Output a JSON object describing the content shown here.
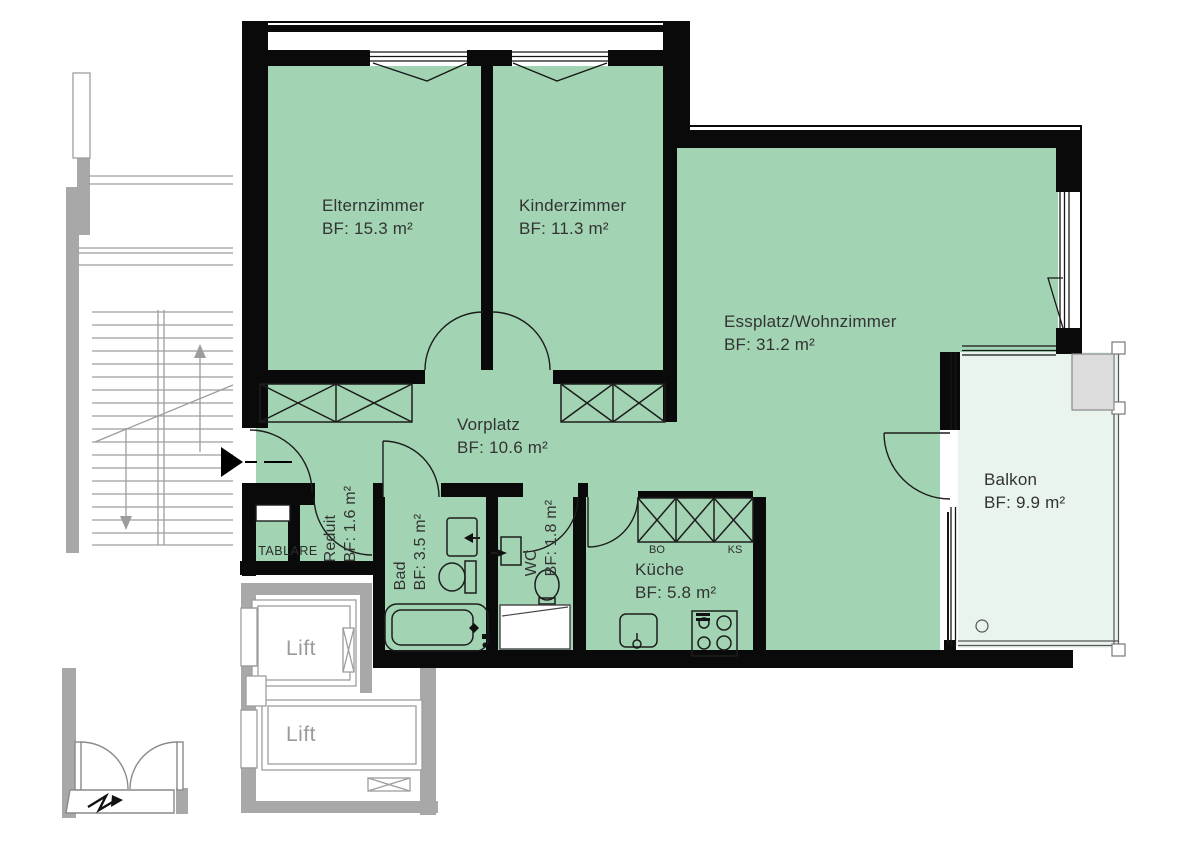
{
  "plan": {
    "title": "Apartment floor plan",
    "rooms": [
      {
        "name": "Elternzimmer",
        "area": "BF: 15.3 m²"
      },
      {
        "name": "Kinderzimmer",
        "area": "BF: 11.3 m²"
      },
      {
        "name": "Essplatz/Wohnzimmer",
        "area": "BF: 31.2 m²"
      },
      {
        "name": "Vorplatz",
        "area": "BF: 10.6 m²"
      },
      {
        "name": "Balkon",
        "area": "BF: 9.9 m²"
      },
      {
        "name": "Küche",
        "area": "BF: 5.8 m²"
      },
      {
        "name": "Reduit",
        "area": "BF: 1.6 m²"
      },
      {
        "name": "Bad",
        "area": "BF: 3.5 m²"
      },
      {
        "name": "WC",
        "area": "BF: 1.8 m²"
      }
    ],
    "fixtures": {
      "tablare": "TABLARE",
      "bo": "BO",
      "ks": "KS"
    },
    "lifts": [
      {
        "label": "Lift"
      },
      {
        "label": "Lift"
      }
    ],
    "colors": {
      "room_fill": "#a2d4b3",
      "balcony_fill": "#e9f4ec",
      "wall": "#0a0a0a",
      "outside_gray": "#a8a8a8",
      "label_text": "#333333",
      "lift_text": "#9b9b9b"
    }
  }
}
